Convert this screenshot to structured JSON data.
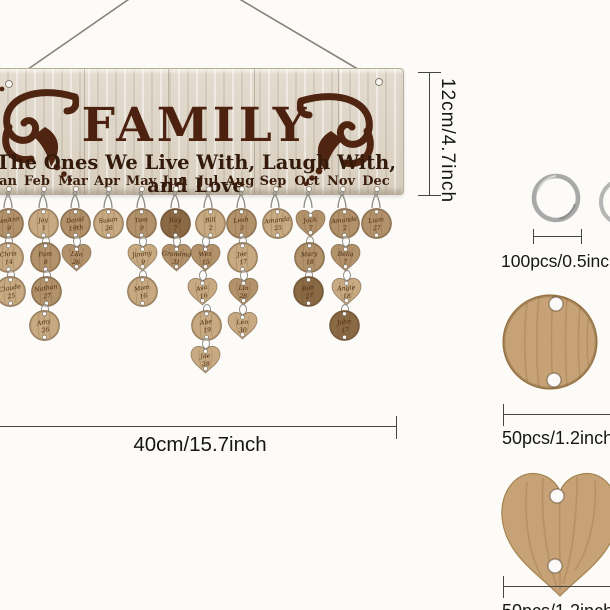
{
  "board": {
    "title": "FAMILY",
    "subtitle": "The Ones We Live With, Laugh With, and Love",
    "months": [
      "Jan",
      "Feb",
      "Mar",
      "Apr",
      "May",
      "Jun",
      "Jul",
      "Aug",
      "Sep",
      "Oct",
      "Nov",
      "Dec"
    ],
    "month_x": [
      5,
      37,
      73,
      107,
      141,
      175,
      208,
      240,
      273,
      307,
      341,
      376
    ],
    "title_color": "#4d2110",
    "wood_base": "#d8cfc0",
    "ornament_color": "#4f2410"
  },
  "tones": {
    "light": "#c7aa81",
    "mid": "#b2926a",
    "dark": "#8a6a45"
  },
  "chains": [
    {
      "month": "Jan",
      "x": 8,
      "discs": [
        {
          "shape": "circle",
          "tone": "mid",
          "name": "LeeAnn",
          "num": "9",
          "dx": 0,
          "rot": -8
        },
        {
          "shape": "circle",
          "tone": "light",
          "name": "Chris",
          "num": "14",
          "dx": 0,
          "rot": -5
        },
        {
          "shape": "circle",
          "tone": "light",
          "name": "Claude",
          "num": "25",
          "dx": 2,
          "rot": -10
        }
      ]
    },
    {
      "month": "Feb",
      "x": 43,
      "discs": [
        {
          "shape": "circle",
          "tone": "light",
          "name": "Joy",
          "num": "1",
          "dx": 0,
          "rot": -6
        },
        {
          "shape": "circle",
          "tone": "mid",
          "name": "Pam",
          "num": "8",
          "dx": 2,
          "rot": -4
        },
        {
          "shape": "circle",
          "tone": "mid",
          "name": "Nathan",
          "num": "27",
          "dx": 3,
          "rot": -9
        },
        {
          "shape": "circle",
          "tone": "light",
          "name": "Amy",
          "num": "26",
          "dx": 1,
          "rot": -12
        }
      ]
    },
    {
      "month": "Mar",
      "x": 75,
      "discs": [
        {
          "shape": "circle",
          "tone": "mid",
          "name": "David",
          "num": "19th",
          "dx": 0,
          "rot": -7
        },
        {
          "shape": "heart",
          "tone": "mid",
          "name": "Lila",
          "num": "26",
          "dx": 1,
          "rot": 4
        }
      ]
    },
    {
      "month": "Apr",
      "x": 108,
      "discs": [
        {
          "shape": "circle",
          "tone": "light",
          "name": "Susan",
          "num": "26",
          "dx": 0,
          "rot": -6
        }
      ]
    },
    {
      "month": "May",
      "x": 141,
      "discs": [
        {
          "shape": "circle",
          "tone": "mid",
          "name": "Tom",
          "num": "9",
          "dx": 0,
          "rot": -5
        },
        {
          "shape": "heart",
          "tone": "light",
          "name": "Jimmy",
          "num": "9",
          "dx": 1,
          "rot": -8
        },
        {
          "shape": "circle",
          "tone": "light",
          "name": "Mom",
          "num": "16",
          "dx": 1,
          "rot": -10
        }
      ]
    },
    {
      "month": "Jun",
      "x": 175,
      "discs": [
        {
          "shape": "circle",
          "tone": "dark",
          "name": "Ray",
          "num": "7",
          "dx": 0,
          "rot": -4
        },
        {
          "shape": "heart",
          "tone": "mid",
          "name": "Grandma",
          "num": "31",
          "dx": 1,
          "rot": 3
        }
      ]
    },
    {
      "month": "Jul",
      "x": 208,
      "discs": [
        {
          "shape": "circle",
          "tone": "light",
          "name": "Bill",
          "num": "2",
          "dx": 2,
          "rot": -6
        },
        {
          "shape": "heart",
          "tone": "mid",
          "name": "Wes",
          "num": "15",
          "dx": -3,
          "rot": -5
        },
        {
          "shape": "heart",
          "tone": "light",
          "name": "Ava",
          "num": "16",
          "dx": -6,
          "rot": -14
        },
        {
          "shape": "circle",
          "tone": "light",
          "name": "Abe",
          "num": "19",
          "dx": -2,
          "rot": -8
        },
        {
          "shape": "heart",
          "tone": "light",
          "name": "Joe",
          "num": "28",
          "dx": -3,
          "rot": -4
        }
      ]
    },
    {
      "month": "Aug",
      "x": 241,
      "discs": [
        {
          "shape": "circle",
          "tone": "mid",
          "name": "Leah",
          "num": "3",
          "dx": 0,
          "rot": -6
        },
        {
          "shape": "circle",
          "tone": "light",
          "name": "Joe",
          "num": "17",
          "dx": 1,
          "rot": -9
        },
        {
          "shape": "heart",
          "tone": "mid",
          "name": "Lin",
          "num": "28",
          "dx": 2,
          "rot": 2
        },
        {
          "shape": "heart",
          "tone": "light",
          "name": "Leo",
          "num": "30",
          "dx": 1,
          "rot": -3
        }
      ]
    },
    {
      "month": "Sep",
      "x": 275,
      "discs": [
        {
          "shape": "circle",
          "tone": "light",
          "name": "Amanda",
          "num": "25",
          "dx": 2,
          "rot": -7
        }
      ]
    },
    {
      "month": "Oct",
      "x": 308,
      "discs": [
        {
          "shape": "heart",
          "tone": "mid",
          "name": "Jack",
          "num": "7",
          "dx": 2,
          "rot": -6
        },
        {
          "shape": "circle",
          "tone": "mid",
          "name": "Mary",
          "num": "18",
          "dx": 1,
          "rot": -5
        },
        {
          "shape": "circle",
          "tone": "dark",
          "name": "Bob",
          "num": "27",
          "dx": 0,
          "rot": -10
        }
      ]
    },
    {
      "month": "Nov",
      "x": 342,
      "discs": [
        {
          "shape": "circle",
          "tone": "mid",
          "name": "Amanda",
          "num": "2",
          "dx": 2,
          "rot": -6
        },
        {
          "shape": "heart",
          "tone": "mid",
          "name": "Bella",
          "num": "7",
          "dx": 3,
          "rot": 2
        },
        {
          "shape": "heart",
          "tone": "light",
          "name": "Angie",
          "num": "18",
          "dx": 4,
          "rot": -4
        },
        {
          "shape": "circle",
          "tone": "dark",
          "name": "John",
          "num": "17",
          "dx": 2,
          "rot": -8
        }
      ]
    },
    {
      "month": "Dec",
      "x": 376,
      "discs": [
        {
          "shape": "circle",
          "tone": "mid",
          "name": "Liam",
          "num": "27",
          "dx": 0,
          "rot": -6
        }
      ]
    }
  ],
  "annotations": {
    "height_label": "12cm/4.7inch",
    "width_label": "40cm/15.7inch",
    "ring_label": "100pcs/0.5inch",
    "round_disc_label": "50pcs/1.2inch",
    "heart_disc_label": "50pcs/1.2inch"
  }
}
